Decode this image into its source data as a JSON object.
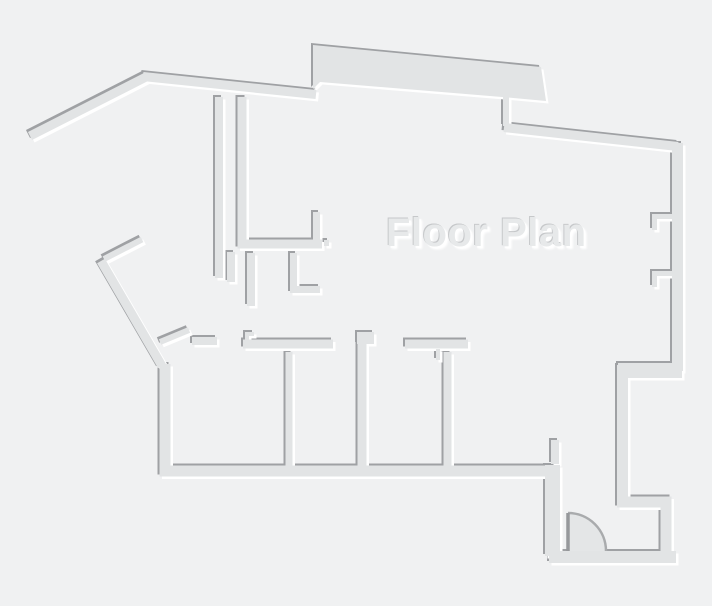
{
  "title": "Floor Plan",
  "canvas": {
    "width_px": 712,
    "height_px": 606
  },
  "colors": {
    "background": "#f0f1f2",
    "wall_fill": "#e2e4e5",
    "wall_edge_dark": "#9fa1a4",
    "wall_edge_highlight": "#ffffff",
    "title_text": "#e7e9ea",
    "title_shadow_dark": "#c6c8ca",
    "door_fill": "#e4e6e7",
    "door_arc": "#a9abad",
    "door_leaf": "#96989b"
  },
  "legend": {
    "drawing_type": "floor-plan",
    "door_swings_visible": 3,
    "wall_style": "embossed"
  }
}
